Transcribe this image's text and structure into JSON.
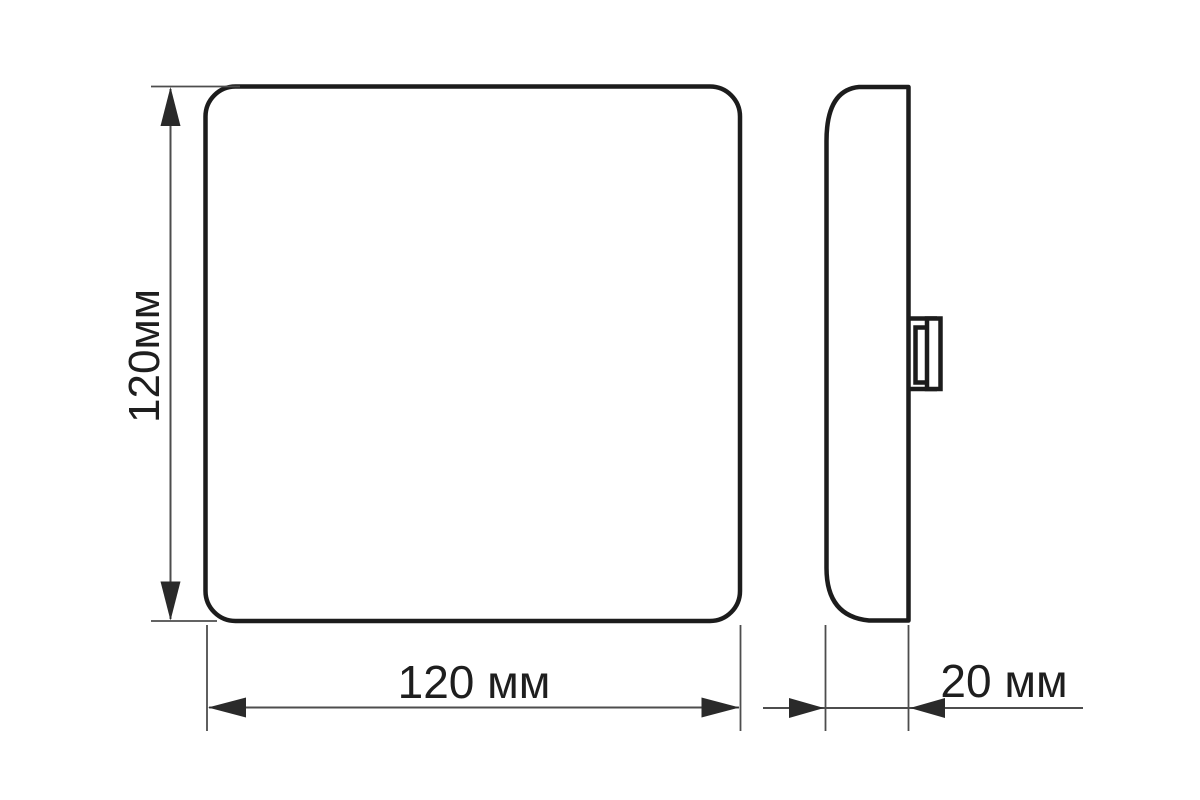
{
  "drawing": {
    "background_color": "#ffffff",
    "outline_color": "#1c1c1c",
    "dimension_line_color": "#4d4d4d",
    "text_color": "#1e1e1e"
  },
  "dimensions": {
    "height": {
      "label": "120мм",
      "value": 120,
      "unit": "мм"
    },
    "width": {
      "label": "120 мм",
      "value": 120,
      "unit": "мм"
    },
    "depth": {
      "label": "20 мм",
      "value": 20,
      "unit": "мм"
    }
  }
}
